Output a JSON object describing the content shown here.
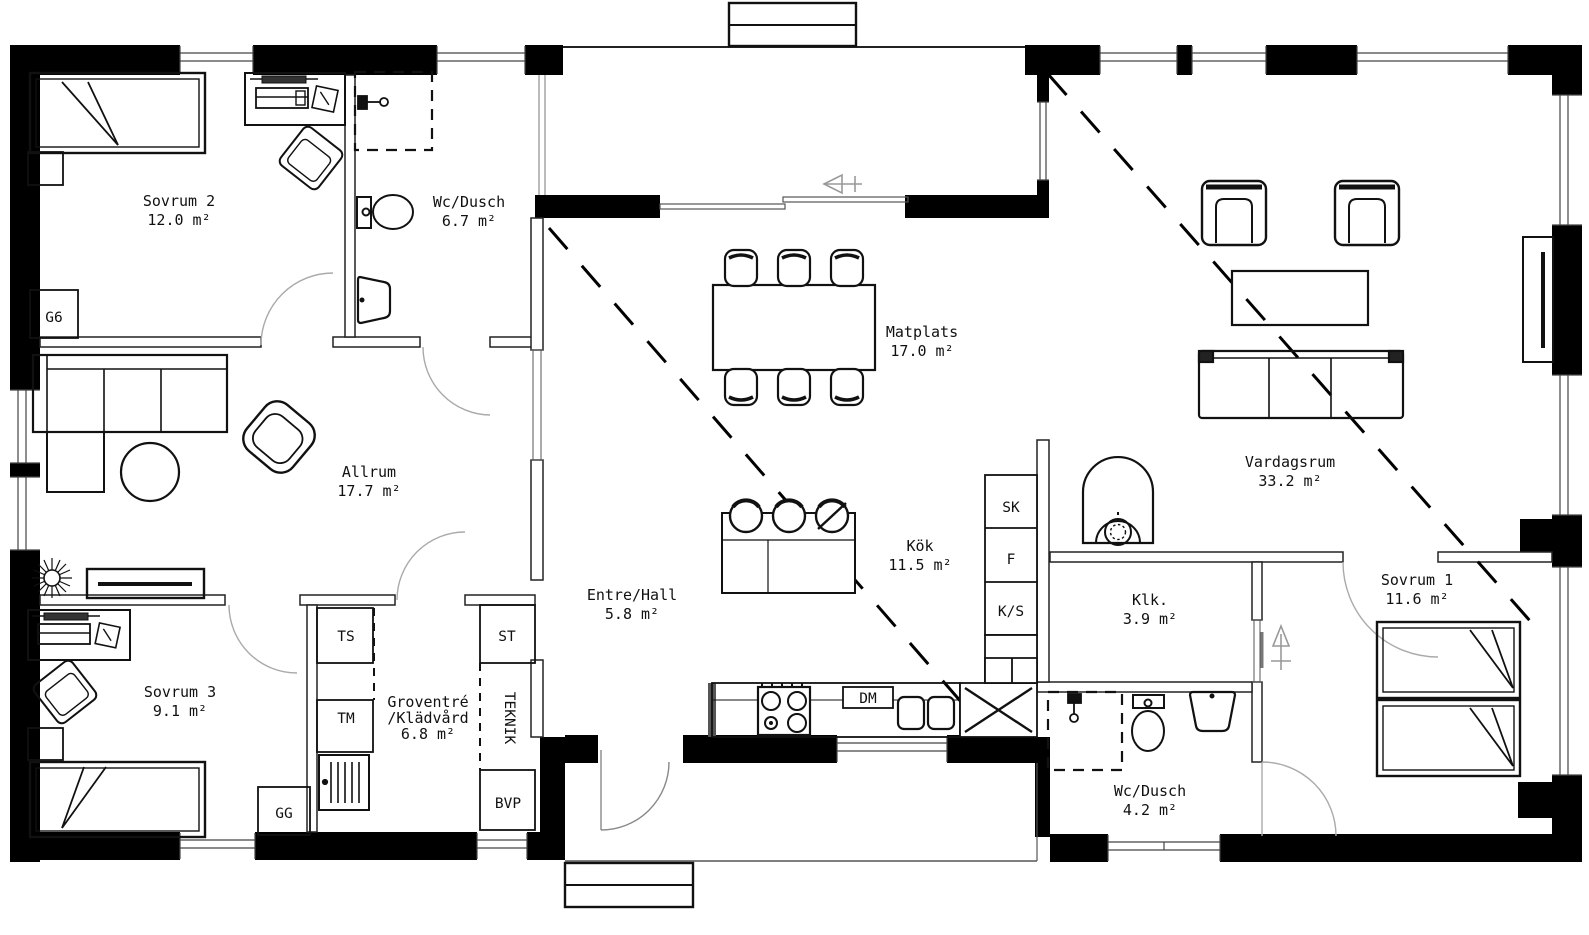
{
  "drawing": {
    "background": "#ffffff",
    "wall_color": "#000000",
    "furniture_color": "#111111",
    "door_color": "#9a9a9a",
    "label_color": "#111111"
  },
  "rooms": [
    {
      "id": "sovrum-2",
      "name": "Sovrum 2",
      "area": "12.0 m²",
      "x": 179,
      "y": 206
    },
    {
      "id": "wc-dusch-1",
      "name": "Wc/Dusch",
      "area": "6.7 m²",
      "x": 469,
      "y": 207
    },
    {
      "id": "allrum",
      "name": "Allrum",
      "area": "17.7 m²",
      "x": 369,
      "y": 477
    },
    {
      "id": "sovrum-3",
      "name": "Sovrum 3",
      "area": "9.1 m²",
      "x": 180,
      "y": 697
    },
    {
      "id": "groventre-kladvard",
      "name": "Groventré",
      "name2": "/Klädvård",
      "area": "6.8 m²",
      "x": 428,
      "y": 707
    },
    {
      "id": "entre-hall",
      "name": "Entre/Hall",
      "area": "5.8 m²",
      "x": 632,
      "y": 600
    },
    {
      "id": "matplats",
      "name": "Matplats",
      "area": "17.0 m²",
      "x": 922,
      "y": 337
    },
    {
      "id": "kok",
      "name": "Kök",
      "area": "11.5 m²",
      "x": 920,
      "y": 551
    },
    {
      "id": "vardagsrum",
      "name": "Vardagsrum",
      "area": "33.2 m²",
      "x": 1290,
      "y": 467
    },
    {
      "id": "klk",
      "name": "Klk.",
      "area": "3.9 m²",
      "x": 1150,
      "y": 605
    },
    {
      "id": "wc-dusch-2",
      "name": "Wc/Dusch",
      "area": "4.2 m²",
      "x": 1150,
      "y": 796
    },
    {
      "id": "sovrum-1",
      "name": "Sovrum 1",
      "area": "11.6 m²",
      "x": 1417,
      "y": 585
    }
  ],
  "fixture_labels": [
    {
      "id": "g6",
      "text": "G6",
      "x": 54,
      "y": 322
    },
    {
      "id": "ts",
      "text": "TS",
      "x": 346,
      "y": 641
    },
    {
      "id": "tm",
      "text": "TM",
      "x": 346,
      "y": 723
    },
    {
      "id": "gg",
      "text": "GG",
      "x": 284,
      "y": 818
    },
    {
      "id": "st",
      "text": "ST",
      "x": 507,
      "y": 641
    },
    {
      "id": "teknik",
      "text": "TEKNIK",
      "x": 505,
      "y": 718,
      "rotate": 90
    },
    {
      "id": "bvp",
      "text": "BVP",
      "x": 508,
      "y": 808
    },
    {
      "id": "sk",
      "text": "SK",
      "x": 1011,
      "y": 512
    },
    {
      "id": "f",
      "text": "F",
      "x": 1011,
      "y": 564
    },
    {
      "id": "ks",
      "text": "K/S",
      "x": 1011,
      "y": 616
    },
    {
      "id": "dm",
      "text": "DM",
      "x": 868,
      "y": 703
    }
  ]
}
